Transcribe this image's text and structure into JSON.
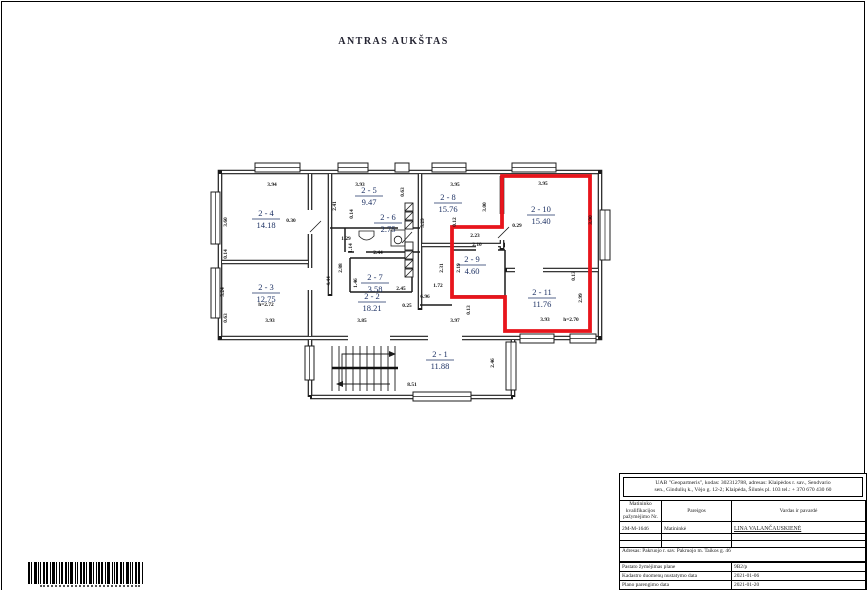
{
  "page": {
    "title": "ANTRAS AUKŠTAS"
  },
  "plan": {
    "highlight_color": "#e8151c",
    "rooms": [
      {
        "id": "2 - 1",
        "area": "11.88",
        "x": 440,
        "y": 360
      },
      {
        "id": "2 - 2",
        "area": "18.21",
        "x": 372,
        "y": 302
      },
      {
        "id": "2 - 3",
        "area": "12.75",
        "x": 266,
        "y": 293
      },
      {
        "id": "2 - 4",
        "area": "14.18",
        "x": 266,
        "y": 219
      },
      {
        "id": "2 - 5",
        "area": "9.47",
        "x": 369,
        "y": 196
      },
      {
        "id": "2 - 6",
        "area": "2.75",
        "x": 388,
        "y": 223
      },
      {
        "id": "2 - 7",
        "area": "3.58",
        "x": 375,
        "y": 283
      },
      {
        "id": "2 - 8",
        "area": "15.76",
        "x": 448,
        "y": 203
      },
      {
        "id": "2 - 9",
        "area": "4.60",
        "x": 472,
        "y": 265
      },
      {
        "id": "2 - 10",
        "area": "15.40",
        "x": 541,
        "y": 215
      },
      {
        "id": "2 - 11",
        "area": "11.76",
        "x": 542,
        "y": 298
      }
    ],
    "dimensions": [
      {
        "t": "3.94",
        "x": 272,
        "y": 186
      },
      {
        "t": "3.93",
        "x": 360,
        "y": 186
      },
      {
        "t": "3.95",
        "x": 455,
        "y": 186
      },
      {
        "t": "3.95",
        "x": 543,
        "y": 185
      },
      {
        "t": "0.30",
        "x": 291,
        "y": 222
      },
      {
        "t": "2.41",
        "x": 336,
        "y": 206,
        "v": true
      },
      {
        "t": "0.14",
        "x": 353,
        "y": 214,
        "v": true
      },
      {
        "t": "0.63",
        "x": 404,
        "y": 192,
        "v": true
      },
      {
        "t": "3.60",
        "x": 227,
        "y": 222,
        "v": true
      },
      {
        "t": "0.14",
        "x": 227,
        "y": 254,
        "v": true
      },
      {
        "t": "3.24",
        "x": 224,
        "y": 292,
        "v": true
      },
      {
        "t": "0.63",
        "x": 227,
        "y": 318,
        "v": true
      },
      {
        "t": "3.93",
        "x": 270,
        "y": 322
      },
      {
        "t": "1.29",
        "x": 346,
        "y": 240
      },
      {
        "t": "1.14",
        "x": 352,
        "y": 248,
        "v": true
      },
      {
        "t": "2.44",
        "x": 378,
        "y": 254
      },
      {
        "t": "2.88",
        "x": 342,
        "y": 268,
        "v": true
      },
      {
        "t": "4.44",
        "x": 330,
        "y": 281,
        "v": true
      },
      {
        "t": "1.46",
        "x": 357,
        "y": 283,
        "v": true
      },
      {
        "t": "2.45",
        "x": 401,
        "y": 290
      },
      {
        "t": "5.29",
        "x": 424,
        "y": 223,
        "v": true
      },
      {
        "t": "0.12",
        "x": 456,
        "y": 222,
        "v": true
      },
      {
        "t": "2.23",
        "x": 475,
        "y": 237
      },
      {
        "t": "3.00",
        "x": 486,
        "y": 207,
        "v": true
      },
      {
        "t": "2.10",
        "x": 477,
        "y": 246
      },
      {
        "t": "2.31",
        "x": 443,
        "y": 268,
        "v": true
      },
      {
        "t": "2.19",
        "x": 460,
        "y": 268,
        "v": true
      },
      {
        "t": "1.72",
        "x": 438,
        "y": 287
      },
      {
        "t": "6.96",
        "x": 425,
        "y": 298
      },
      {
        "t": "0.25",
        "x": 407,
        "y": 307
      },
      {
        "t": "3.85",
        "x": 362,
        "y": 322
      },
      {
        "t": "3.97",
        "x": 455,
        "y": 322
      },
      {
        "t": "0.13",
        "x": 470,
        "y": 310,
        "v": true
      },
      {
        "t": "0.29",
        "x": 517,
        "y": 227
      },
      {
        "t": "3.90",
        "x": 592,
        "y": 220,
        "v": true
      },
      {
        "t": "0.13",
        "x": 575,
        "y": 276,
        "v": true
      },
      {
        "t": "2.99",
        "x": 582,
        "y": 298,
        "v": true
      },
      {
        "t": "3.93",
        "x": 545,
        "y": 321
      },
      {
        "t": "h=2.70",
        "x": 571,
        "y": 321
      },
      {
        "t": "h=2.72",
        "x": 266,
        "y": 306
      },
      {
        "t": "8.51",
        "x": 412,
        "y": 386
      },
      {
        "t": "2.46",
        "x": 494,
        "y": 363,
        "v": true
      }
    ]
  },
  "title_block": {
    "company_line1": "UAB \"Geopartneris\", kodas: 302312788, adresas: Klaipėdos r. sav., Sendvario",
    "company_line2": "sen., Gindulių k., Vėjo g. 12-2; Klaipėda, Šilutės pl. 103 tel.: + 370 670 430 60",
    "headers": [
      "Matininko kvalifikacijos pažymėjimo Nr.",
      "Pareigos",
      "Vardas ir pavardė"
    ],
    "surveyor": {
      "certificate_no": "2M-M-1646",
      "position": "Matininkė",
      "name": "LINA VALANČAUSKIENĖ"
    },
    "address": "Adresas: Pakruojo r. sav. Pakruojo m. Taikos g. 46",
    "info_rows": [
      {
        "label": "Pastato žymėjimas plane",
        "value": "9B2/p"
      },
      {
        "label": "Kadastro duomenų nustatymo data",
        "value": "2021-01-06"
      },
      {
        "label": "Plano parengimo data",
        "value": "2021-01-20"
      }
    ]
  }
}
